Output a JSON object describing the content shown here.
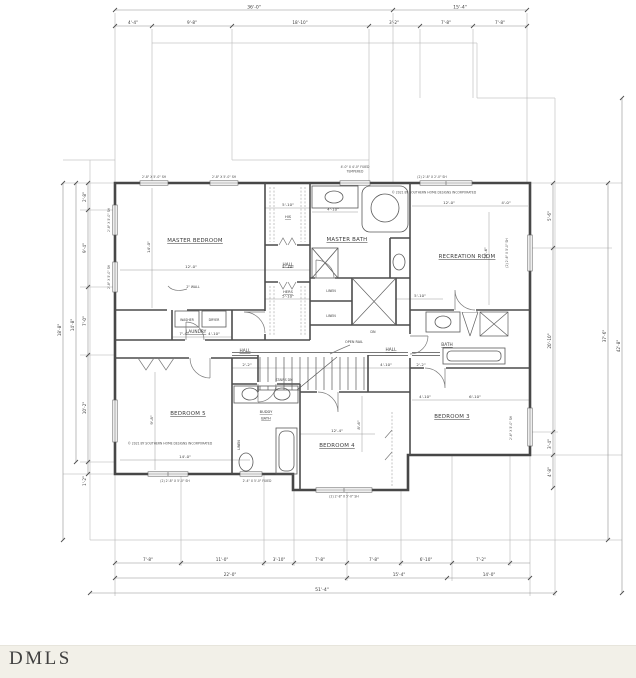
{
  "watermark": "DMLS",
  "copyright": "© 2021 BY SOUTHERN HOME DESIGNS INCORPORATED",
  "rooms": {
    "master_bedroom": "MASTER BEDROOM",
    "master_bath": "MASTER BATH",
    "recreation": "RECREATION ROOM",
    "bedroom3": "BEDROOM 3",
    "bedroom4": "BEDROOM 4",
    "bedroom5": "BEDROOM 5",
    "buddy_line1": "BUDDY",
    "buddy_line2": "BATH",
    "bath": "BATH",
    "laundry": "LAUNDRY",
    "hall": "HALL",
    "his": "HIS",
    "hers": "HERS",
    "linen": "LINEN",
    "washer": "WASHER",
    "dryer": "DRYER",
    "stairs": "STAIRS DN",
    "open_rail": "OPEN RAIL",
    "dn": "DN",
    "wall_note": "2\" WALL"
  },
  "dims": {
    "top1": [
      "36'-0\"",
      "15'-4\""
    ],
    "top2": [
      "4'-4\"",
      "9'-8\"",
      "18'-10\"",
      "3'-2\"",
      "7'-8\"",
      "7'-8\""
    ],
    "bottom1": [
      "7'-8\"",
      "11'-0\"",
      "3'-10\"",
      "7'-8\"",
      "7'-8\"",
      "6'-10\"",
      "7'-2\""
    ],
    "bottom2": [
      "22'-0\"",
      "15'-4\"",
      "14'-0\""
    ],
    "bottom3": "51'-4\"",
    "left": [
      "2'-8\"",
      "9'-4\"",
      "7'-0\"",
      "10'-2\"",
      "1'-2\"",
      "14'-8\"",
      "18'-8\""
    ],
    "right": [
      "5'-6\"",
      "20'-10\"",
      "3'-4\"",
      "4'-8\"",
      "37'-6\"",
      "42'-8\""
    ],
    "interior": {
      "mb_w": "12'-0\"",
      "mb_h": "14'-0\"",
      "closet_w": "5'-10\"",
      "bath_vanity": "4'-10\"",
      "rec_w": "12'-0\"",
      "rec_e": "4'-0\"",
      "rec_h": "16'-6\"",
      "b5_w": "14'-0\"",
      "b5_h": "9'-8\"",
      "b4_w": "12'-4\"",
      "b4_h": "8'-6\"",
      "b3_a": "4'-10\"",
      "b3_b": "6'-10\"",
      "laundry_a": "7'-4\"",
      "laundry_b": "4'-10\"",
      "hall_a": "2'-2\"",
      "hall_b": "4'-10\"",
      "chase": "5'-10\""
    }
  },
  "windows": {
    "sh_2_8": "2'-8\" X 5'-0\" SH",
    "fixed_line1": "4'-0\" X 4'-0\" FIXED",
    "fixed_line2": "TEMPERED",
    "rec_top": "(2) 2'-8\" X 2'-0\" SH",
    "right_rec": "(2) 2'-6\" X 5'-0\" SH",
    "right_b3": "2'-6\" X 5'-0\" SH",
    "bottom_pair": "(2) 2'-8\" X 5'-0\" SH",
    "bottom_fixed": "2'-4\" X 5'-0\" FIXED"
  }
}
